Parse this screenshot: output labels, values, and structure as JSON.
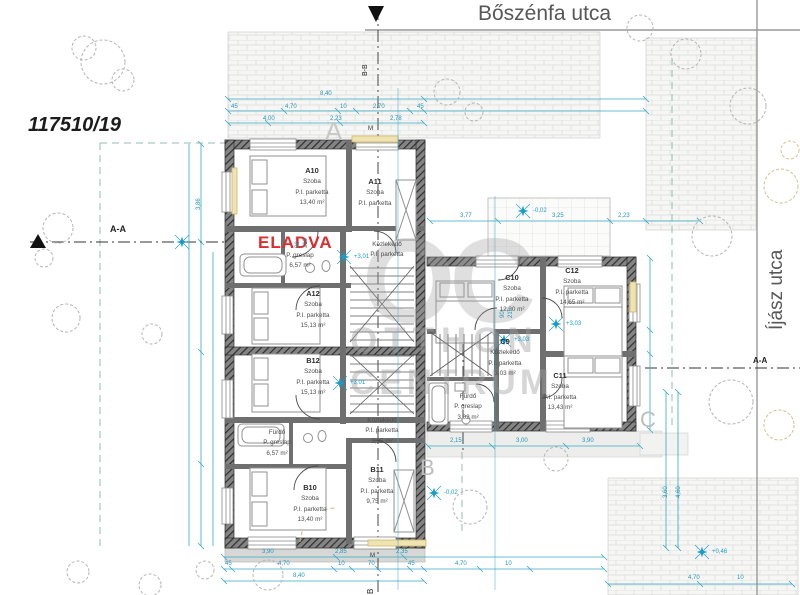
{
  "labels": {
    "parcel": "117510/19",
    "street_top": "Bőszénfa utca",
    "street_right": "Íjász utca",
    "sold": "ELADVA",
    "yard_a": "A",
    "yard_b": "B",
    "yard_c": "C",
    "cut_aa_left": "A-A",
    "cut_aa_right": "A-A",
    "cut_bb_top": "B-B",
    "cut_b_bottom": "B",
    "marker_m": "M"
  },
  "watermark": {
    "logo": "OC",
    "name1": "OTTHON",
    "name2": "CENTRUM"
  },
  "rooms": [
    {
      "id": "A10",
      "type": "Szoba",
      "floor": "P.I. parketta",
      "area": "13,40 m²"
    },
    {
      "id": "A11",
      "type": "Szoba",
      "floor": "P.I. parketta",
      "area": ""
    },
    {
      "id": "A12",
      "type": "Szoba",
      "floor": "P.I. parketta",
      "area": "15,13 m²"
    },
    {
      "id": "B12",
      "type": "Szoba",
      "floor": "P.I. parketta",
      "area": "15,13 m²"
    },
    {
      "id": "B10",
      "type": "Szoba",
      "floor": "P.I. parketta",
      "area": "13,40 m²"
    },
    {
      "id": "B11",
      "type": "Szoba",
      "floor": "P.I. parketta",
      "area": "9,75 m²"
    },
    {
      "id": "C10",
      "type": "Szoba",
      "floor": "P.I. parketta",
      "area": "12,20 m²"
    },
    {
      "id": "C12",
      "type": "Szoba",
      "floor": "P.I. parketta",
      "area": "14,65 m²"
    },
    {
      "id": "C11",
      "type": "Szoba",
      "floor": "P.I. parketta",
      "area": "13,43 m²"
    },
    {
      "id": "C9",
      "type": "Közlekedő",
      "floor": "P.I. parketta",
      "area": "3,03 m²"
    }
  ],
  "areas": [
    {
      "name": "P. greslap",
      "line2": "6,57 m²",
      "line3": ""
    },
    {
      "name": "Közlekedő",
      "line2": "P.I. parketta",
      "line3": ""
    },
    {
      "name": "Fürdő",
      "line2": "P. greslap",
      "line3": "6,57 m²"
    },
    {
      "name": "Közlekedő",
      "line2": "P.I. parketta",
      "line3": "5,95 m²"
    },
    {
      "name": "Fürdő",
      "line2": "P. greslap",
      "line3": "3,02 m²"
    }
  ],
  "dims": [
    "8,40",
    "45",
    "4,70",
    "10",
    "2,70",
    "45",
    "4,00",
    "2,23",
    "2,78",
    "3,77",
    "3,25",
    "2,23",
    "2,15",
    "3,00",
    "3,90",
    "3,90",
    "2,85",
    "2,35",
    "45",
    "4,70",
    "10",
    "70",
    "45",
    "8,40",
    "4,70",
    "10",
    "4,70",
    "10",
    "3,86",
    "3,60",
    "4,60",
    "90",
    "210",
    "90",
    "210"
  ],
  "levels": [
    "+3,01",
    "+3,01",
    "+3,03",
    "+3,03",
    "-0,02",
    "-0,02",
    "+0,46"
  ],
  "colors": {
    "dimension": "#2496B8",
    "level_marker": "#1A9CC9",
    "sold_red": "#E02C2C",
    "wall": "#3A3A3A",
    "accent_yellow": "#EFE0A8",
    "watermark_gray": "#A0A0A0"
  }
}
